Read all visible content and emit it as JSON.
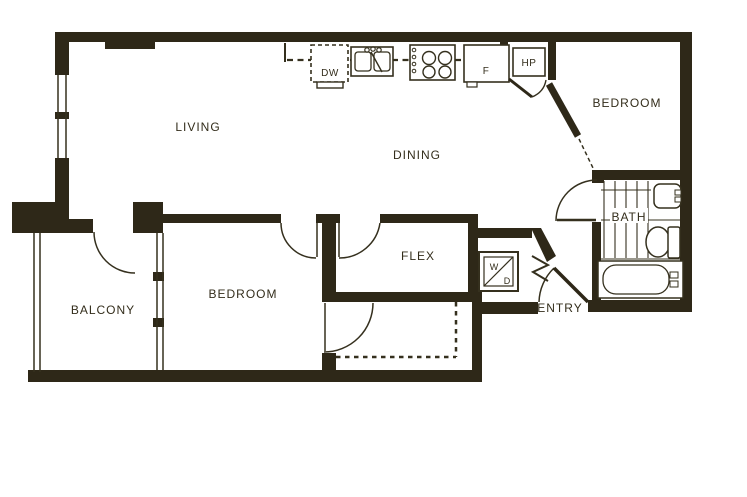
{
  "plan": {
    "rooms": {
      "living": "LIVING",
      "dining": "DINING",
      "bedroom_upper": "BEDROOM",
      "bedroom_lower": "BEDROOM",
      "bath": "BATH",
      "flex": "FLEX",
      "balcony": "BALCONY",
      "entry": "ENTRY"
    },
    "labels": {
      "dishwasher": "DW",
      "fridge": "F",
      "heat_pump": "HP",
      "washer": "W",
      "dryer": "D"
    },
    "colors": {
      "wall": "#2e2818",
      "background": "#ffffff"
    }
  }
}
